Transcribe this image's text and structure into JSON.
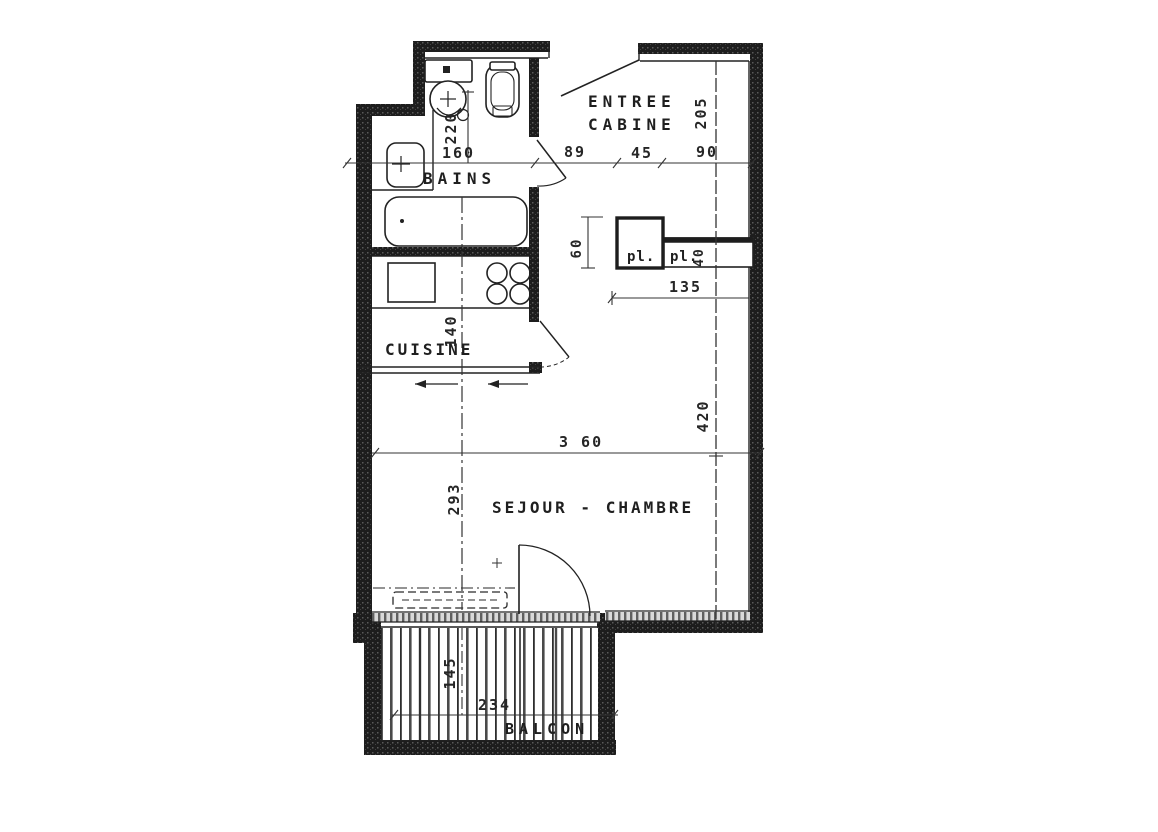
{
  "drawing": {
    "type": "apartment floor plan (scanned architectural drawing)",
    "ink_color": "#1f1f1f",
    "paper_color": "#ffffff"
  },
  "rooms": {
    "entree": {
      "line1": "ENTREE",
      "line2": "CABINE"
    },
    "bains": {
      "label": "BAINS"
    },
    "cuisine": {
      "label": "CUISINE"
    },
    "sejour_chambre": {
      "label": "SEJOUR - CHAMBRE"
    },
    "balcon": {
      "label": "BALCON"
    },
    "closet_left": {
      "label": "pl."
    },
    "closet_right": {
      "label": "pl."
    }
  },
  "dimensions": {
    "bains_width": "160",
    "wc_depth": "220",
    "entree_seg1": "89",
    "entree_seg2": "45",
    "entree_seg3": "90",
    "entree_depth": "205",
    "closet_depth": "60",
    "closet_right_depth": "40",
    "closets_width": "135",
    "cuisine_depth": "140",
    "sejour_width": "3 60",
    "sejour_depth_right": "420",
    "sejour_depth_left": "293",
    "balcon_depth": "145",
    "balcon_width": "234"
  }
}
